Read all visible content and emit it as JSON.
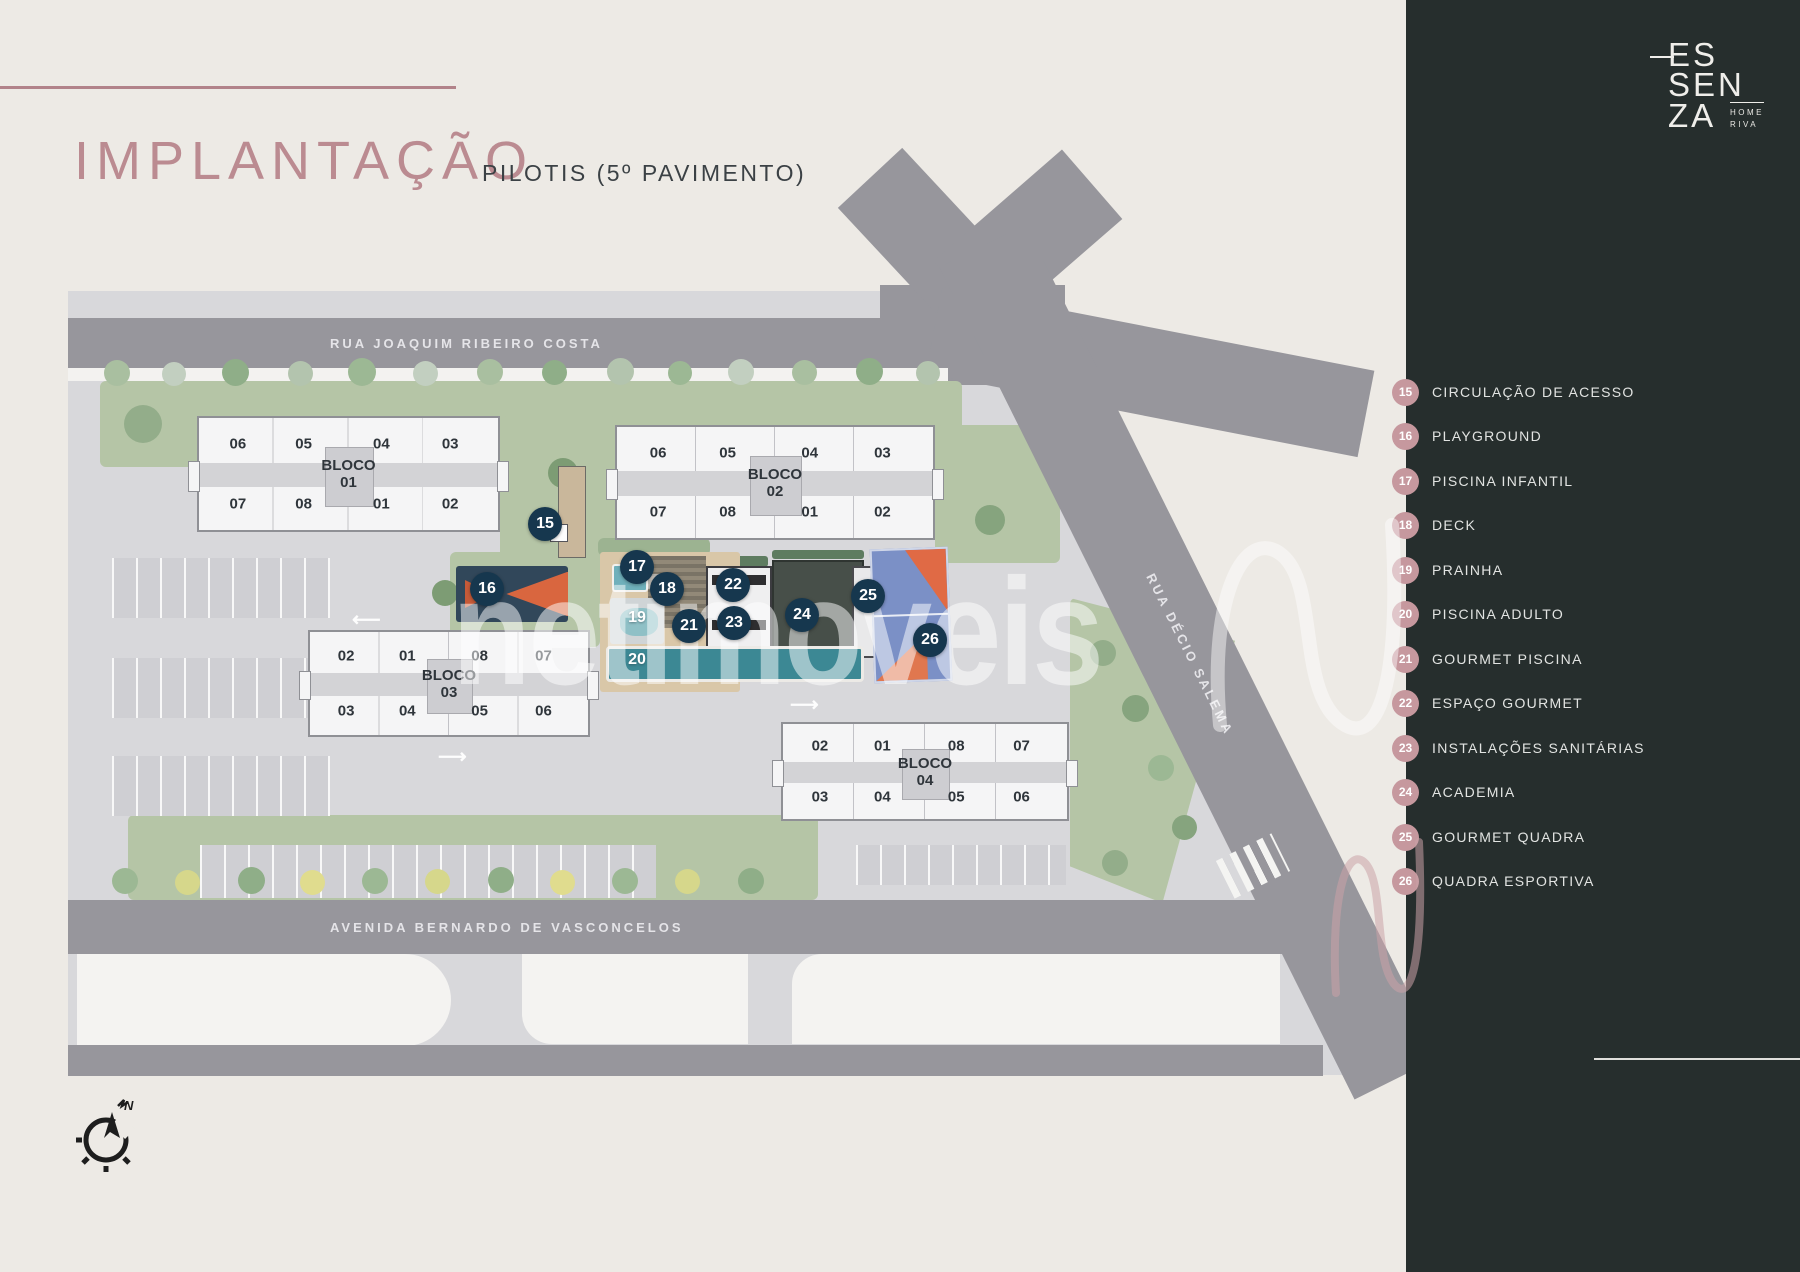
{
  "header": {
    "title": "IMPLANTAÇÃO",
    "subtitle": "PILOTIS (5º PAVIMENTO)"
  },
  "logo": {
    "line1": "ES",
    "line2": "SEN",
    "line3": "ZA",
    "sub1": "HOME",
    "sub2": "RIVA"
  },
  "legend": {
    "items": [
      {
        "num": "15",
        "label": "CIRCULAÇÃO DE ACESSO"
      },
      {
        "num": "16",
        "label": "PLAYGROUND"
      },
      {
        "num": "17",
        "label": "PISCINA INFANTIL"
      },
      {
        "num": "18",
        "label": "DECK"
      },
      {
        "num": "19",
        "label": "PRAINHA"
      },
      {
        "num": "20",
        "label": "PISCINA ADULTO"
      },
      {
        "num": "21",
        "label": "GOURMET PISCINA"
      },
      {
        "num": "22",
        "label": "ESPAÇO GOURMET"
      },
      {
        "num": "23",
        "label": "INSTALAÇÕES SANITÁRIAS"
      },
      {
        "num": "24",
        "label": "ACADEMIA"
      },
      {
        "num": "25",
        "label": "GOURMET QUADRA"
      },
      {
        "num": "26",
        "label": "QUADRA ESPORTIVA"
      }
    ]
  },
  "map": {
    "streets": {
      "top": "RUA JOAQUIM RIBEIRO COSTA",
      "right": "RUA DÉCIO SALEMA",
      "bottom": "AVENIDA BERNARDO DE VASCONCELOS"
    },
    "blocks": [
      {
        "name": "BLOCO",
        "number": "01",
        "top": [
          "06",
          "05",
          "04",
          "03"
        ],
        "bottom": [
          "07",
          "08",
          "01",
          "02"
        ]
      },
      {
        "name": "BLOCO",
        "number": "02",
        "top": [
          "06",
          "05",
          "04",
          "03"
        ],
        "bottom": [
          "07",
          "08",
          "01",
          "02"
        ]
      },
      {
        "name": "BLOCO",
        "number": "03",
        "top": [
          "02",
          "01",
          "08",
          "07"
        ],
        "bottom": [
          "03",
          "04",
          "05",
          "06"
        ]
      },
      {
        "name": "BLOCO",
        "number": "04",
        "top": [
          "02",
          "01",
          "08",
          "07"
        ],
        "bottom": [
          "03",
          "04",
          "05",
          "06"
        ]
      }
    ],
    "compass_label": "N"
  },
  "watermark": {
    "text": "netimoveis"
  },
  "colors": {
    "background_cream": "#edeae5",
    "sidebar_dark": "#262e2d",
    "accent_rose": "#bb8b91",
    "badge_pink": "#c6989e",
    "marker_navy": "#16374e",
    "road_gray": "#97969c",
    "lawn_green": "#b5c5a6",
    "pool_teal": "#3c8894",
    "court_blue": "#7b90c6",
    "court_orange": "#e06a45"
  }
}
